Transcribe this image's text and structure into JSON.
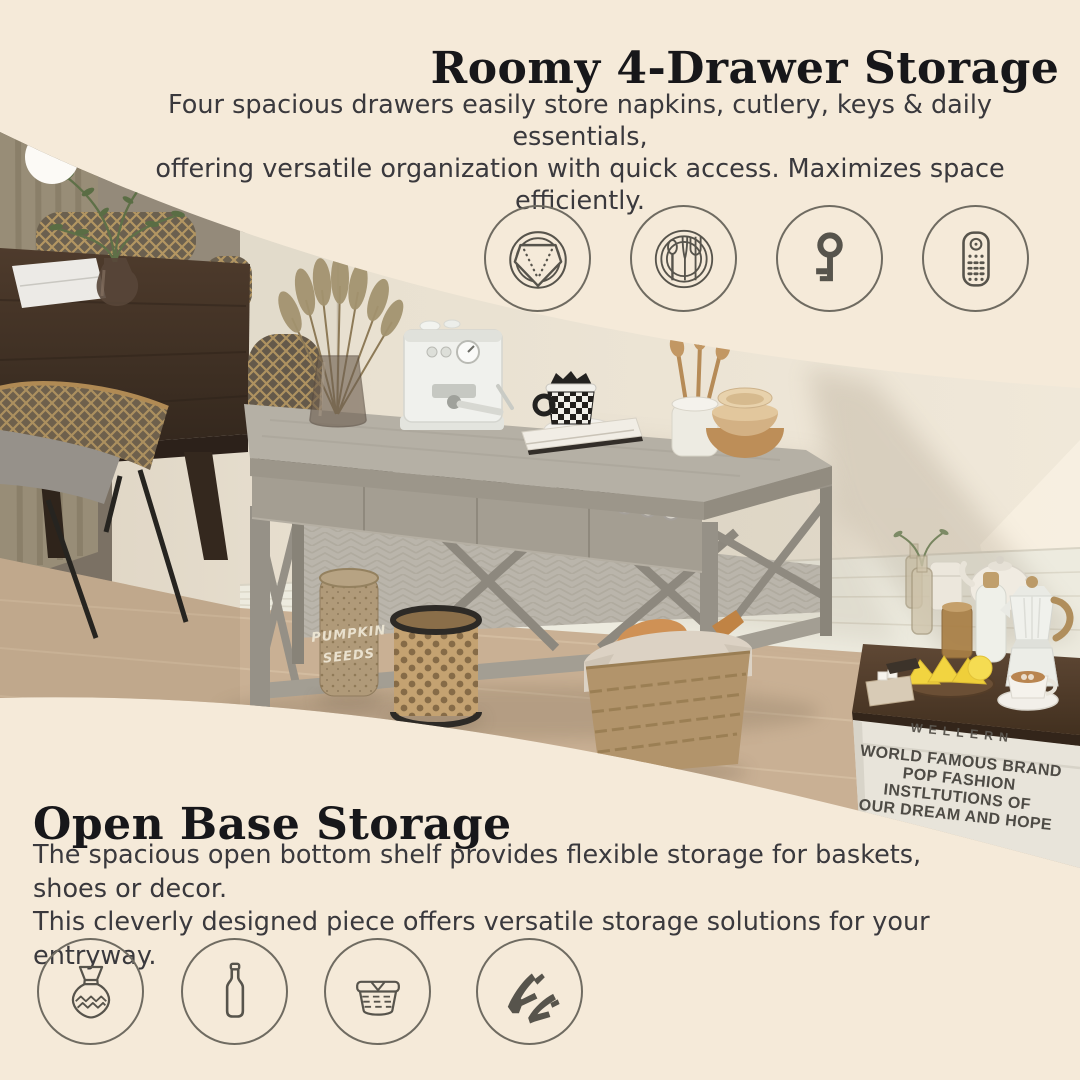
{
  "top_section": {
    "title": "Roomy 4-Drawer Storage",
    "desc_line1": "Four spacious drawers easily store napkins, cutlery, keys & daily essentials,",
    "desc_line2": "offering versatile organization with quick access. Maximizes space efficiently.",
    "icons": [
      {
        "name": "napkin-icon",
        "label": "napkins"
      },
      {
        "name": "cutlery-icon",
        "label": "cutlery"
      },
      {
        "name": "key-icon",
        "label": "keys"
      },
      {
        "name": "remote-icon",
        "label": "remote control"
      }
    ]
  },
  "bottom_section": {
    "title": "Open Base Storage",
    "desc_line1": "The spacious open bottom shelf provides flexible storage for baskets, shoes or decor.",
    "desc_line2": "This cleverly designed piece offers versatile storage solutions for your entryway.",
    "icons": [
      {
        "name": "vase-icon",
        "label": "vase"
      },
      {
        "name": "bottle-icon",
        "label": "bottle"
      },
      {
        "name": "basket-icon",
        "label": "basket"
      },
      {
        "name": "heels-icon",
        "label": "high heels"
      }
    ]
  },
  "photo": {
    "crate": {
      "brand": "WELLERN",
      "line1": "WORLD FAMOUS BRAND",
      "line2": "POP FASHION",
      "line3": "INSTLTUTIONS OF",
      "line4": "OUR DREAM AND HOPE"
    },
    "jar": {
      "line1": "PUMPKIN",
      "line2": "SEEDS"
    }
  },
  "colors": {
    "background": "#f5ead9",
    "heading_text": "#17171a",
    "body_text": "#3a393d",
    "icon_circle_stroke": "#6f6b61",
    "icon_glyph": "#57544c",
    "console_wood": "#a49e92",
    "floor_wood": "#c9b094",
    "wall": "#e9e1d1"
  }
}
